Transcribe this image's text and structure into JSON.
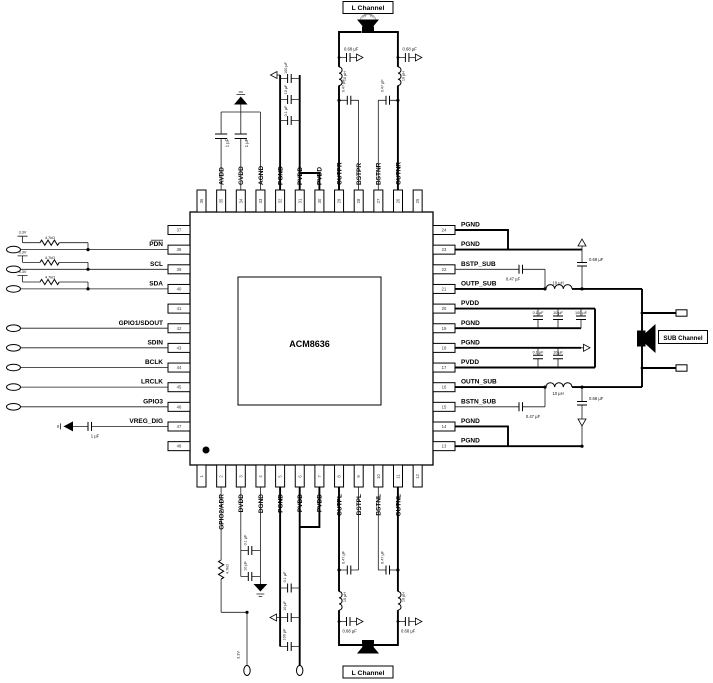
{
  "chip": {
    "name": "ACM8636"
  },
  "pins": {
    "top": [
      {
        "num": "36",
        "label": ""
      },
      {
        "num": "35",
        "label": "AVDD"
      },
      {
        "num": "34",
        "label": "GVDD"
      },
      {
        "num": "33",
        "label": "AGND"
      },
      {
        "num": "32",
        "label": "PGND"
      },
      {
        "num": "31",
        "label": "PVDD"
      },
      {
        "num": "30",
        "label": "PVDD"
      },
      {
        "num": "29",
        "label": "OUTPR"
      },
      {
        "num": "28",
        "label": "BSTPR"
      },
      {
        "num": "27",
        "label": "BSTNR"
      },
      {
        "num": "26",
        "label": "OUTNR"
      },
      {
        "num": "25",
        "label": ""
      }
    ],
    "bottom": [
      {
        "num": "1",
        "label": ""
      },
      {
        "num": "2",
        "label": "GPIO2/ADR"
      },
      {
        "num": "3",
        "label": "DVDD"
      },
      {
        "num": "4",
        "label": "DGND"
      },
      {
        "num": "5",
        "label": "PGND"
      },
      {
        "num": "6",
        "label": "PVDD"
      },
      {
        "num": "7",
        "label": "PVDD"
      },
      {
        "num": "8",
        "label": "OUTPL"
      },
      {
        "num": "9",
        "label": "BSTPL"
      },
      {
        "num": "10",
        "label": "BSTNL"
      },
      {
        "num": "11",
        "label": "OUTNL"
      },
      {
        "num": "12",
        "label": ""
      }
    ],
    "left": [
      {
        "num": "37",
        "label": ""
      },
      {
        "num": "38",
        "label": "PDN"
      },
      {
        "num": "39",
        "label": "SCL"
      },
      {
        "num": "40",
        "label": "SDA"
      },
      {
        "num": "41",
        "label": ""
      },
      {
        "num": "42",
        "label": "GPIO1/SDOUT"
      },
      {
        "num": "43",
        "label": "SDIN"
      },
      {
        "num": "44",
        "label": "BCLK"
      },
      {
        "num": "45",
        "label": "LRCLK"
      },
      {
        "num": "46",
        "label": "GPIO3"
      },
      {
        "num": "47",
        "label": "VREG_DIG"
      },
      {
        "num": "48",
        "label": ""
      }
    ],
    "right": [
      {
        "num": "24",
        "label": "PGND"
      },
      {
        "num": "23",
        "label": "PGND"
      },
      {
        "num": "22",
        "label": "BSTP_SUB"
      },
      {
        "num": "21",
        "label": "OUTP_SUB"
      },
      {
        "num": "20",
        "label": "PVDD"
      },
      {
        "num": "19",
        "label": "PGND"
      },
      {
        "num": "18",
        "label": "PGND"
      },
      {
        "num": "17",
        "label": "PVDD"
      },
      {
        "num": "16",
        "label": "OUTN_SUB"
      },
      {
        "num": "15",
        "label": "BSTN_SUB"
      },
      {
        "num": "14",
        "label": "PGND"
      },
      {
        "num": "13",
        "label": "PGND"
      }
    ]
  },
  "channels": {
    "top": "L Channel",
    "bottom": "L Channel",
    "sub": "SUB Channel"
  },
  "components": {
    "cap_1uF": "1 µF",
    "cap_01uF": "0.1 µF",
    "cap_10uF": "10 µF",
    "cap_100uF": "100 µF",
    "cap_047uF": "0.47 µF",
    "cap_068uF": "0.68 µF",
    "ind_10uH": "10 µH",
    "res_47k": "4.7kΩ",
    "v_33": "3.3V"
  }
}
